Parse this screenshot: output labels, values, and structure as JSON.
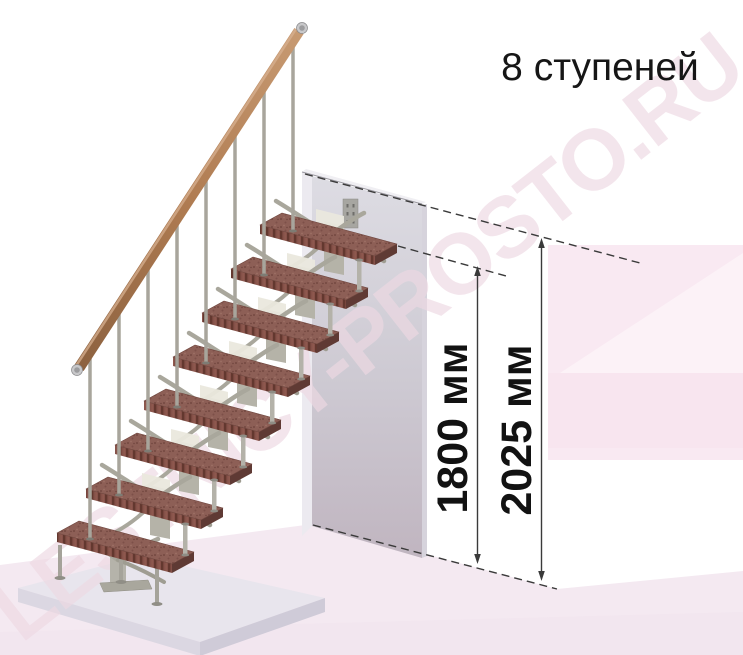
{
  "title": "8 ступеней",
  "watermark": "LESTNICY-PROSTO.RU",
  "stair": {
    "steps_count": 8,
    "treads_material_color": "#8d5f56",
    "handrail_color": "#b07c52",
    "metal_color": "#a8a59c",
    "wall_color": "#c9c2cc",
    "background_accent": "#f9e9f2",
    "line_color": "#3a3a3a"
  },
  "dimensions": [
    {
      "id": "height-to-top-step",
      "label": "1800 мм",
      "value": 1800,
      "unit": "мм"
    },
    {
      "id": "total-height",
      "label": "2025 мм",
      "value": 2025,
      "unit": "мм"
    }
  ]
}
